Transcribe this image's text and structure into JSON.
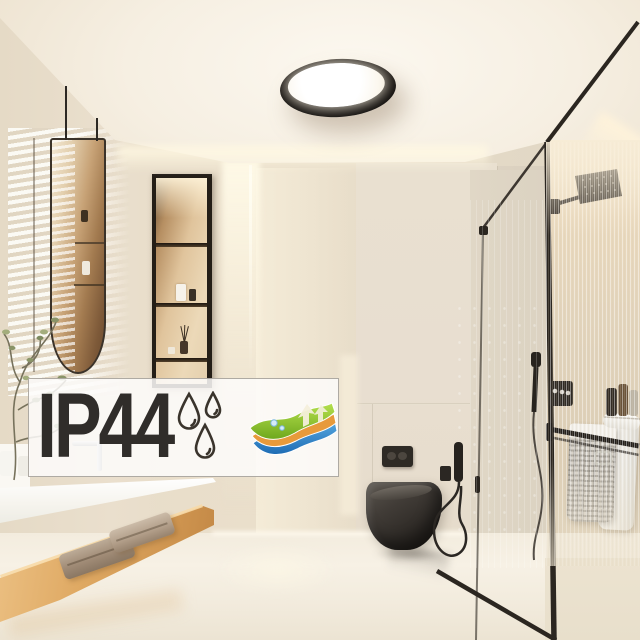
{
  "image_type": "product-lifestyle-photo",
  "subject": "round black LED ceiling light mounted in a modern beige bathroom",
  "overlay_badge": {
    "text": "IP44",
    "text_color": "#302d2a",
    "background_color": "rgba(253,252,250,0.86)",
    "border_color": "#9b968e",
    "icons": [
      {
        "name": "water-drops-icon",
        "meaning": "splash protection",
        "stroke_color": "#3a342c"
      },
      {
        "name": "breathable-layers-icon",
        "meaning": "layered moisture protection",
        "layer_colors": {
          "top": "#8cc62e",
          "middle": "#e79a3b",
          "bottom": "#2f85cc"
        },
        "arrow_color": "#f4efdb",
        "droplet_color": "#d6ecfa"
      }
    ]
  },
  "scene": {
    "room": "bathroom",
    "palette": {
      "ceiling": "#f6efe2",
      "walls": "#e9dfce",
      "floor": "#f3ecde",
      "wood_bench": "#dfa963",
      "black_fixtures": "#2c2723",
      "led_glow": "#fff8e2"
    },
    "objects": [
      "ceiling-light",
      "suspended-mirror",
      "window-blinds-light",
      "recessed-shelf-niche",
      "perfume-bottles",
      "reed-diffuser",
      "led-strip-light",
      "glass-shower-enclosure",
      "rain-shower-head",
      "falling-water",
      "hand-shower",
      "shower-control-plate",
      "towel-rail",
      "hanging-towels",
      "shampoo-bottles",
      "wall-hung-toilet",
      "flush-plate",
      "bidet-sprayer",
      "vanity-counter",
      "faucet",
      "wood-bench",
      "folded-towels",
      "plant"
    ]
  }
}
